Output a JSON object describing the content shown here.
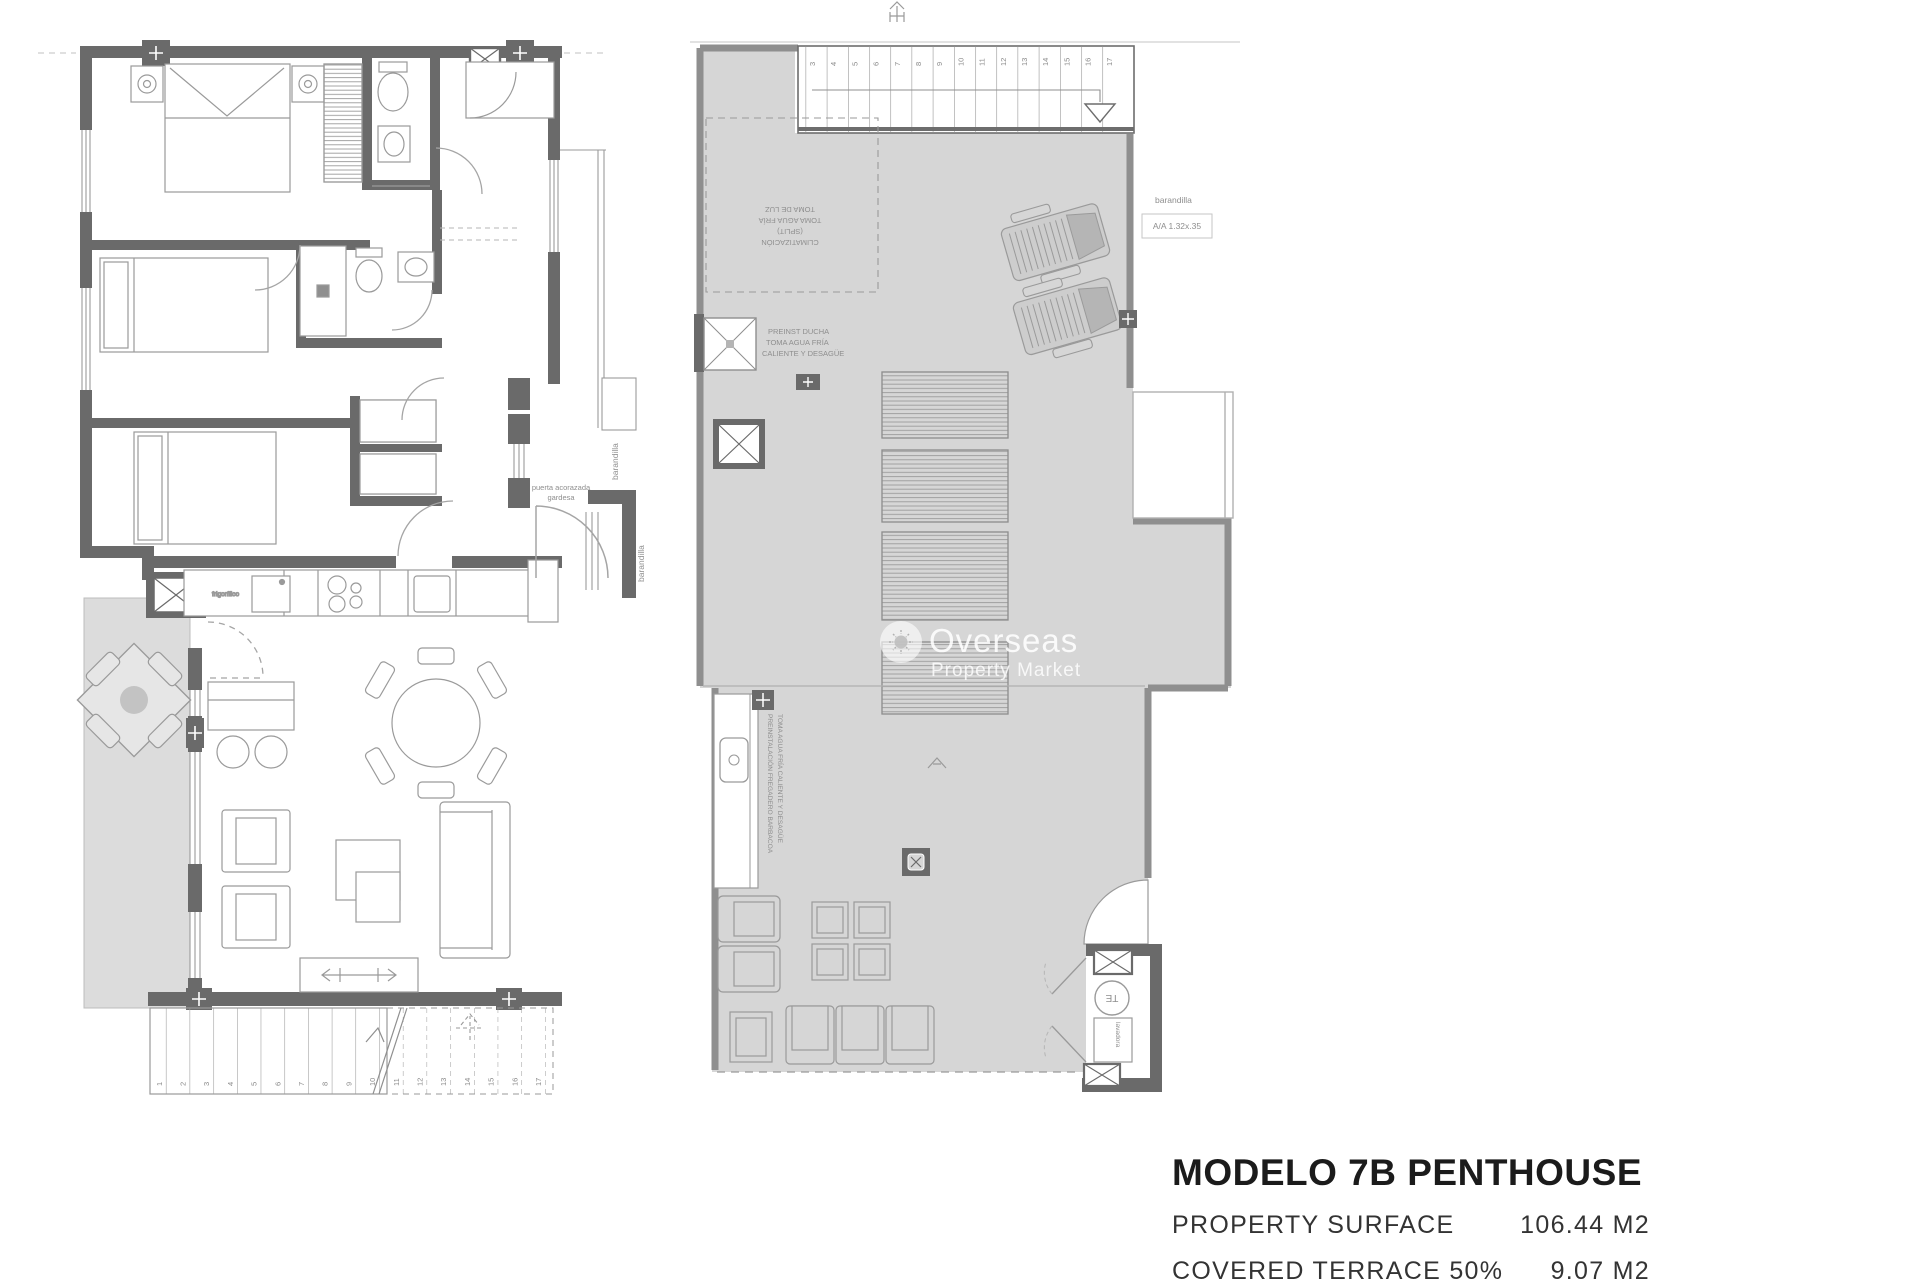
{
  "colors": {
    "wall_dark": "#6a6a6a",
    "wall_gray": "#8f8f8f",
    "terrace_fill_right": "#d6d6d6",
    "terrace_fill_left": "#dcdcdc",
    "line_gray": "#9a9a9a",
    "text_gray": "#8e8e8e",
    "title_text": "#1b1b1b"
  },
  "watermark": {
    "brand": "Overseas",
    "tagline": "Property Market"
  },
  "title_block": {
    "title": "MODELO 7B PENTHOUSE",
    "rows": [
      {
        "label": "PROPERTY SURFACE",
        "value": "106.44 M2"
      },
      {
        "label": "COVERED TERRACE 50%",
        "value": "9.07 M2"
      }
    ]
  },
  "plan_labels": {
    "barandilla_wing_upper": "barandilla",
    "barandilla_wing_lower": "barandilla",
    "barandilla_roof": "barandilla",
    "aa_unit": "A/A 1.32x.35",
    "entry_door_line1": "puerta acorazada",
    "entry_door_line2": "gardesa",
    "fridge": "frigorífico",
    "te_heater": "TE",
    "lavadora": "lavadora",
    "shower_lines": [
      "PREINST DUCHA",
      "TOMA AGUA FRÍA",
      "CALIENTE Y DESAGÜE"
    ],
    "pergola_lines": [
      "CLIMATIZACIÓN",
      "(SPLIT)",
      "TOMA AGUA FRÍA",
      "TOMA DE LUZ"
    ],
    "bbq_lines": [
      "PREINSTALACIÓN FREGADERO BARBACOA",
      "TOMA AGUA FRÍA CALIENTE Y DESAGÜE"
    ]
  },
  "stairs": {
    "lower": [
      "1",
      "2",
      "3",
      "4",
      "5",
      "6",
      "7",
      "8",
      "9",
      "10",
      "11",
      "12",
      "13",
      "14",
      "15",
      "16",
      "17"
    ],
    "upper": [
      "3",
      "4",
      "5",
      "6",
      "7",
      "8",
      "9",
      "10",
      "11",
      "12",
      "13",
      "14",
      "15",
      "16",
      "17"
    ]
  }
}
